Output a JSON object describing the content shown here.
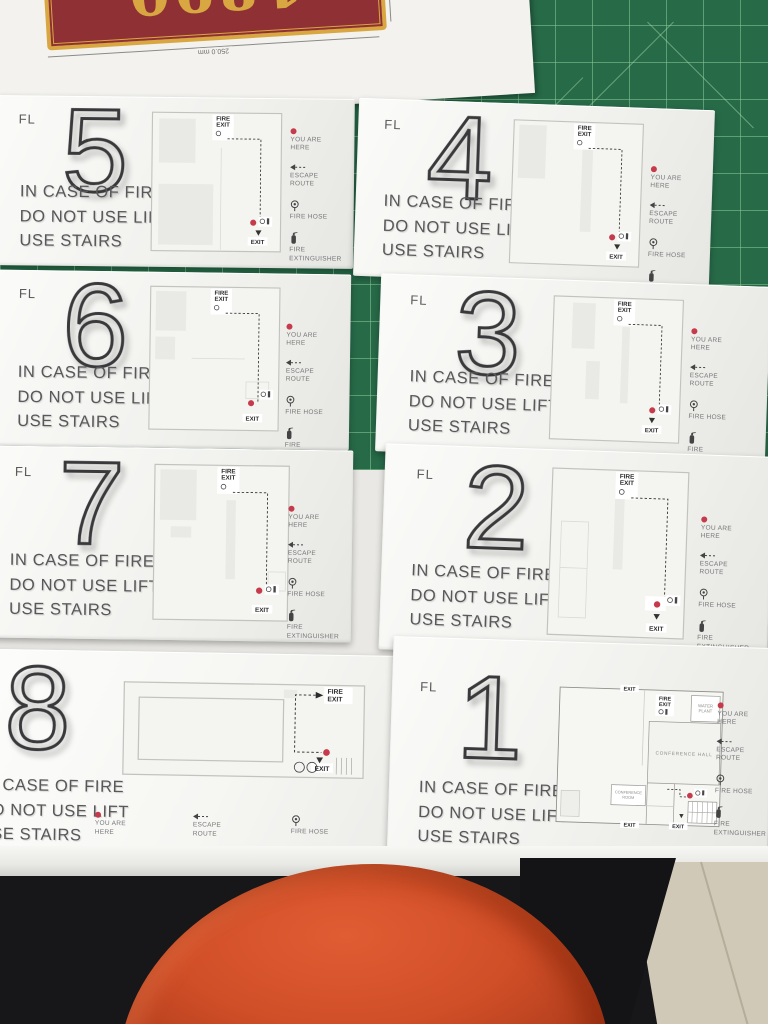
{
  "paper": {
    "plaque_number": "1890",
    "width_dim": "250.0 mm",
    "height_dim": "100.0 mm"
  },
  "common": {
    "fl_label": "FL",
    "warning_lines": [
      "IN CASE OF FIRE",
      "DO NOT USE LIFT",
      "USE STAIRS"
    ],
    "legend": {
      "you_are_here": "YOU ARE HERE",
      "escape_route": "ESCAPE ROUTE",
      "fire_hose": "FIRE HOSE",
      "fire_extinguisher": "FIRE EXTINGUISHER"
    },
    "plan": {
      "fire": "FIRE",
      "exit": "EXIT"
    }
  },
  "signs": {
    "fl5": {
      "number": "5"
    },
    "fl4": {
      "number": "4"
    },
    "fl6": {
      "number": "6"
    },
    "fl3": {
      "number": "3"
    },
    "fl7": {
      "number": "7"
    },
    "fl2": {
      "number": "2"
    },
    "fl8": {
      "number": "8"
    },
    "fl1": {
      "number": "1",
      "rooms": {
        "conference_hall": "CONFERENCE HALL",
        "water_plant_line1": "WATER",
        "water_plant_line2": "PLANT",
        "conference_room_line1": "CONFERENCE",
        "conference_room_line2": "ROOM"
      }
    }
  },
  "colors": {
    "mat_green": "#276a48",
    "red_dot": "#c63b4c",
    "plaque_red": "#8f3134",
    "plaque_gold": "#d9a742",
    "knee_orange": "#d14f28"
  }
}
